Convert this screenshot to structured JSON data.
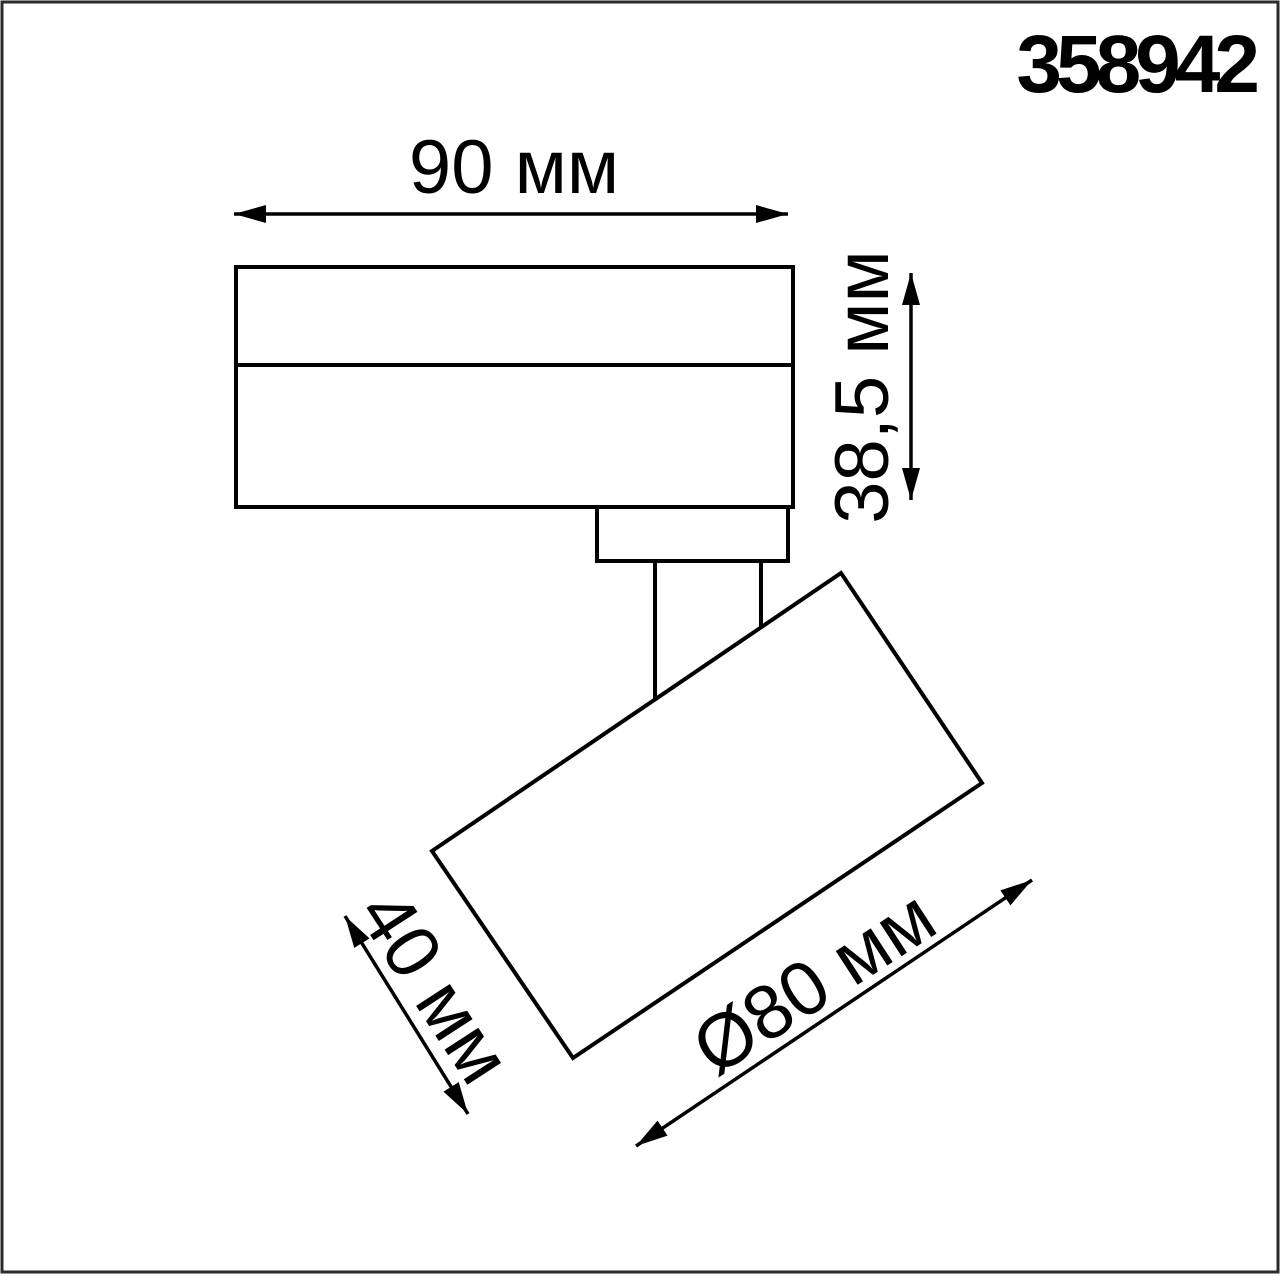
{
  "product_code": "358942",
  "dimensions": {
    "body_width": "90 мм",
    "body_height": "38,5 мм",
    "head_depth": "40 мм",
    "head_diameter": "Ø80 мм"
  },
  "colors": {
    "line": "#000000",
    "frame": "#2b2b2b",
    "background": "#ffffff"
  }
}
